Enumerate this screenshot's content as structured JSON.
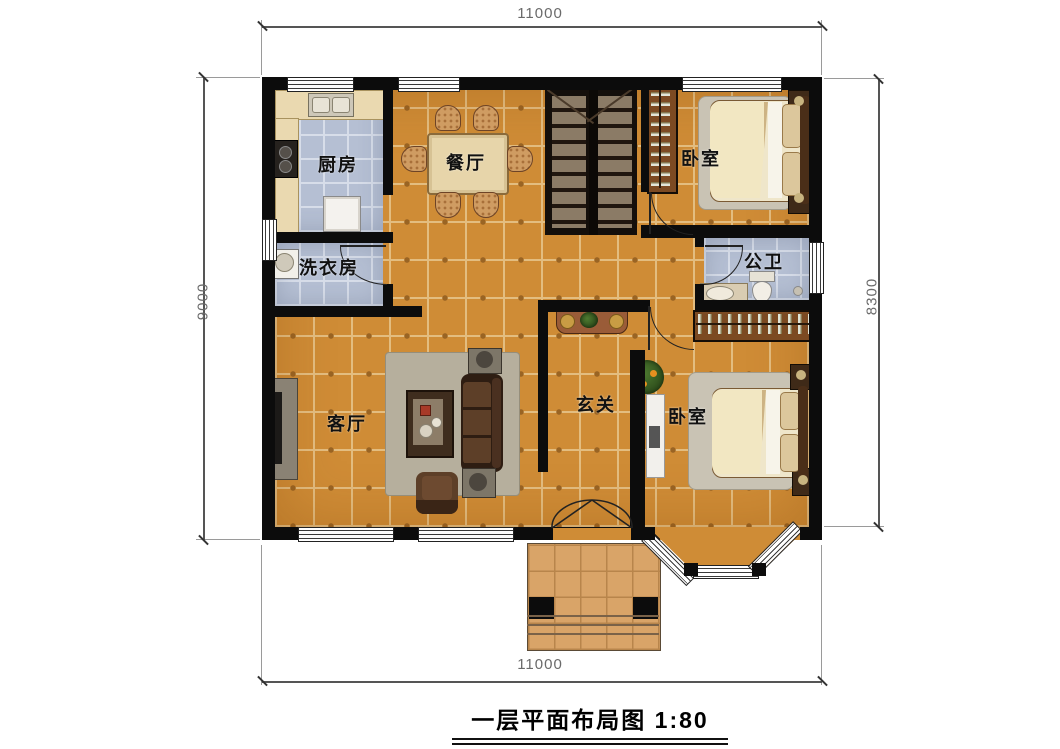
{
  "title": "一层平面布局图 1:80",
  "dimensions": {
    "top": "11000",
    "bottom": "11000",
    "left": "9000",
    "right": "8300"
  },
  "rooms": {
    "kitchen": "厨房",
    "dining": "餐厅",
    "bedroom_top": "卧室",
    "laundry": "洗衣房",
    "bathroom": "公卫",
    "living": "客厅",
    "foyer": "玄关",
    "bedroom_bottom": "卧室"
  },
  "colors": {
    "floor_tile": "#cf8c36",
    "wet_room_tile": "#b5bfd3",
    "porch_tile": "#d9a468",
    "wall": "#0c0c0c",
    "wood": "#7c4a22"
  }
}
